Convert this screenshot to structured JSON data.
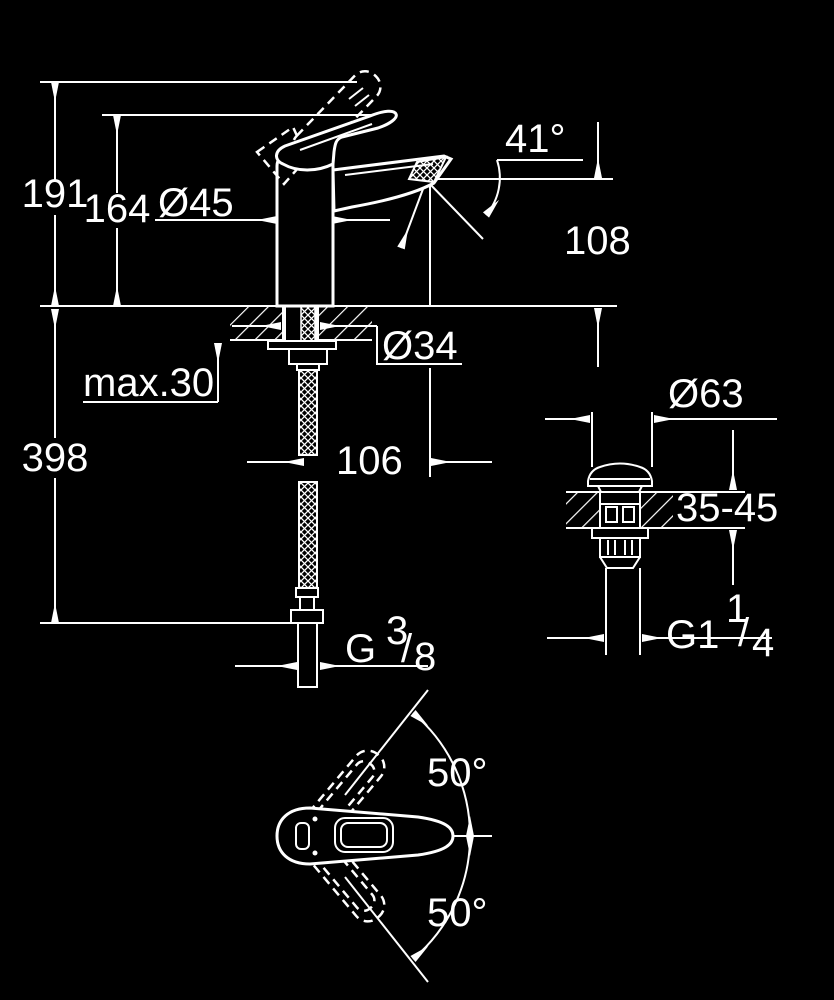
{
  "page": {
    "background": "#000000",
    "ink": "#ffffff"
  },
  "side_view": {
    "dims": {
      "total_height": "191",
      "handle_height": "164",
      "body_diameter": "Ø45",
      "spout_angle": "41°",
      "outlet_height": "108",
      "max_deck_thickness": "max.30",
      "hole_diameter": "Ø34",
      "under_deck_length": "398",
      "spout_reach": "106",
      "supply_thread": {
        "prefix": "G",
        "numerator": "3",
        "slash": "/",
        "denominator": "8"
      }
    }
  },
  "waste_view": {
    "dims": {
      "cap_diameter": "Ø63",
      "deck_thickness_range": "35-45",
      "waste_thread": {
        "prefix": "G1",
        "numerator": "1",
        "slash": "/",
        "denominator": "4"
      }
    }
  },
  "top_view": {
    "dims": {
      "swing_up": "50°",
      "swing_down": "50°"
    }
  }
}
